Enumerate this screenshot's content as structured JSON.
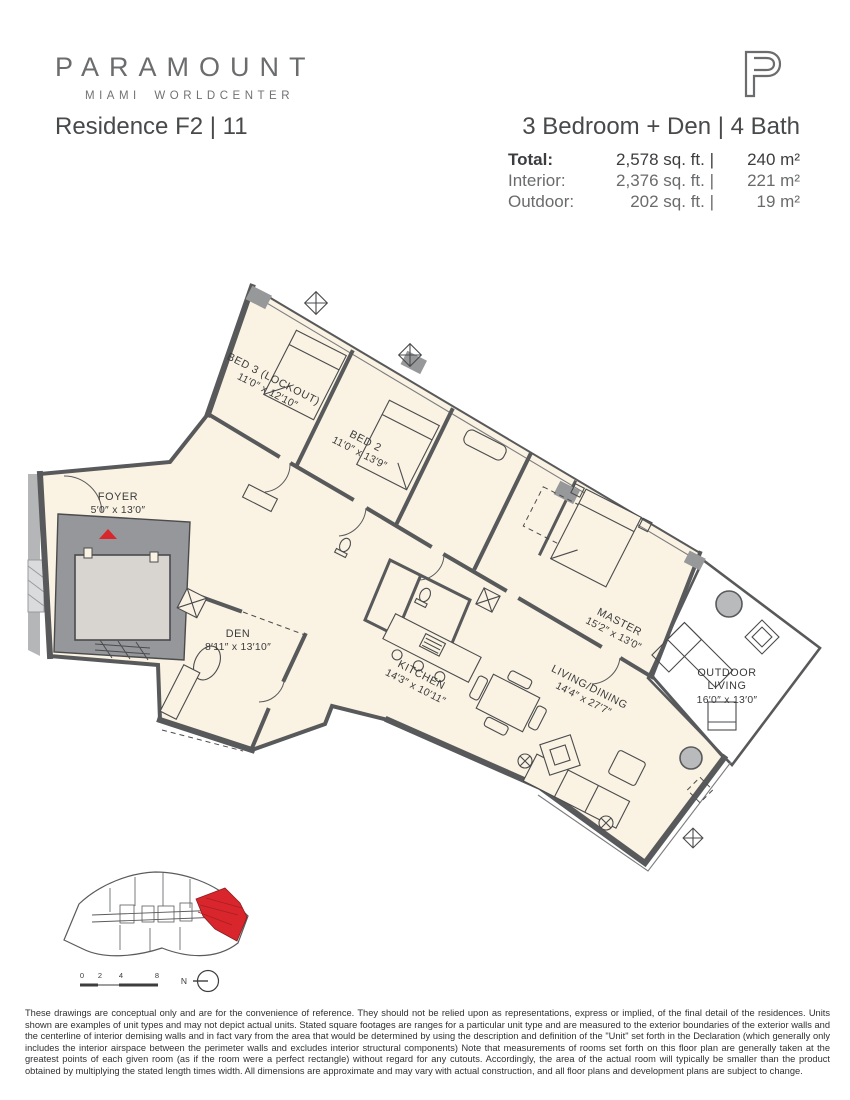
{
  "colors": {
    "accent_red": "#D8262C",
    "plan_cream": "#FAF3E3",
    "wall_gray": "#58595B",
    "core_gray": "#96979A",
    "brand_gray": "#6B6C6E"
  },
  "icons": {
    "monogram": "paramount-p-logo",
    "entry": "entry-arrow-icon",
    "north": "north-arrow-icon"
  },
  "brand": {
    "name": "PARAMOUNT",
    "tagline": "MIAMI WORLDCENTER"
  },
  "header": {
    "residence_title": "Residence F2 | 11",
    "unit_config": "3 Bedroom + Den | 4 Bath",
    "stats": [
      {
        "label": "Total:",
        "sqft": "2,578 sq. ft. |",
        "m2": "240 m²"
      },
      {
        "label": "Interior:",
        "sqft": "2,376 sq. ft. |",
        "m2": "221 m²"
      },
      {
        "label": "Outdoor:",
        "sqft": "202 sq. ft. |",
        "m2": "19 m²"
      }
    ]
  },
  "plan": {
    "rooms": [
      {
        "name": "BED 3 (LOCKOUT)",
        "dims": "11′0″ x 12′10″"
      },
      {
        "name": "BED 2",
        "dims": "11′0″ x 13′9″"
      },
      {
        "name": "FOYER",
        "dims": "5′0″ x 13′0″"
      },
      {
        "name": "DEN",
        "dims": "8′11″ x 13′10″"
      },
      {
        "name": "KITCHEN",
        "dims": "14′3″ x 10′11″"
      },
      {
        "name": "LIVING/DINING",
        "dims": "14′4″ x 27′7″"
      },
      {
        "name": "MASTER",
        "dims": "15′2″ x 13′0″"
      },
      {
        "line1": "OUTDOOR",
        "line2": "LIVING",
        "dims": "16′0″ x 13′0″"
      }
    ]
  },
  "keymap": {
    "scale_labels": [
      "0",
      "2",
      "4",
      "8"
    ],
    "north_label": "N"
  },
  "disclaimer": "These drawings are conceptual only and are for the convenience of reference. They should not be relied upon as representations, express or implied, of the final detail of the residences. Units shown are examples of unit types and may not depict actual units. Stated square footages are ranges for a particular unit type and are measured to the exterior boundaries of the exterior walls and the centerline of interior demising walls and in fact vary from the area that would be determined by using the description and definition of the \"Unit\" set forth in the Declaration (which generally only includes the interior airspace between the perimeter walls and excludes interior structural components) Note that measurements of rooms set forth on this floor plan are generally taken at the greatest points of each given room (as if the room were a perfect rectangle) without regard for any cutouts. Accordingly, the area of the actual room will typically be smaller than the product obtained by multiplying the stated length times width. All dimensions are approximate and may vary with actual construction, and all floor plans and development plans are subject to change."
}
